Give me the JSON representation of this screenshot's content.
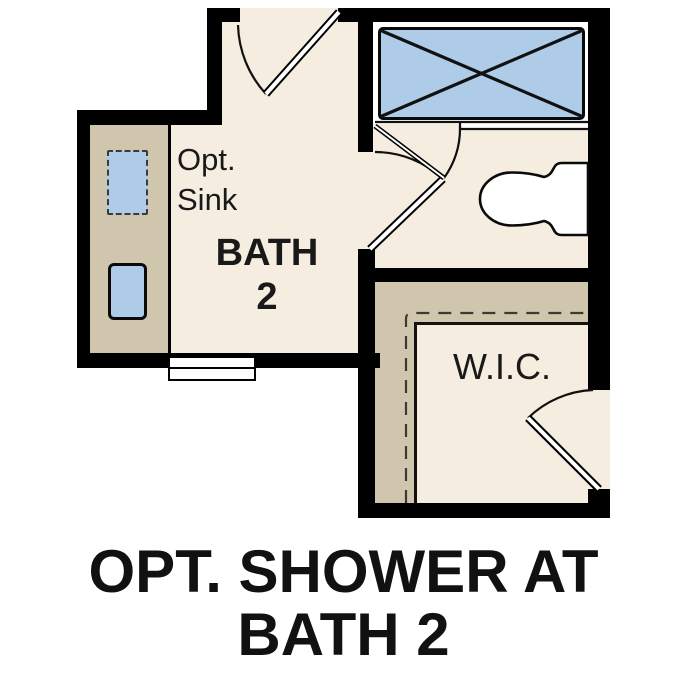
{
  "colors": {
    "wall": "#000000",
    "floor": "#f4ede0",
    "counter": "#d0c5ad",
    "fixture": "#aecbe8",
    "outline": "#0a0a0a",
    "ink": "#191919"
  },
  "labels": {
    "opt_sink_line1": "Opt.",
    "opt_sink_line2": "Sink",
    "bath_name": "BATH",
    "bath_number": "2",
    "wic": "W.I.C."
  },
  "caption": {
    "line1": "OPT. SHOWER AT",
    "line2": "BATH 2"
  }
}
